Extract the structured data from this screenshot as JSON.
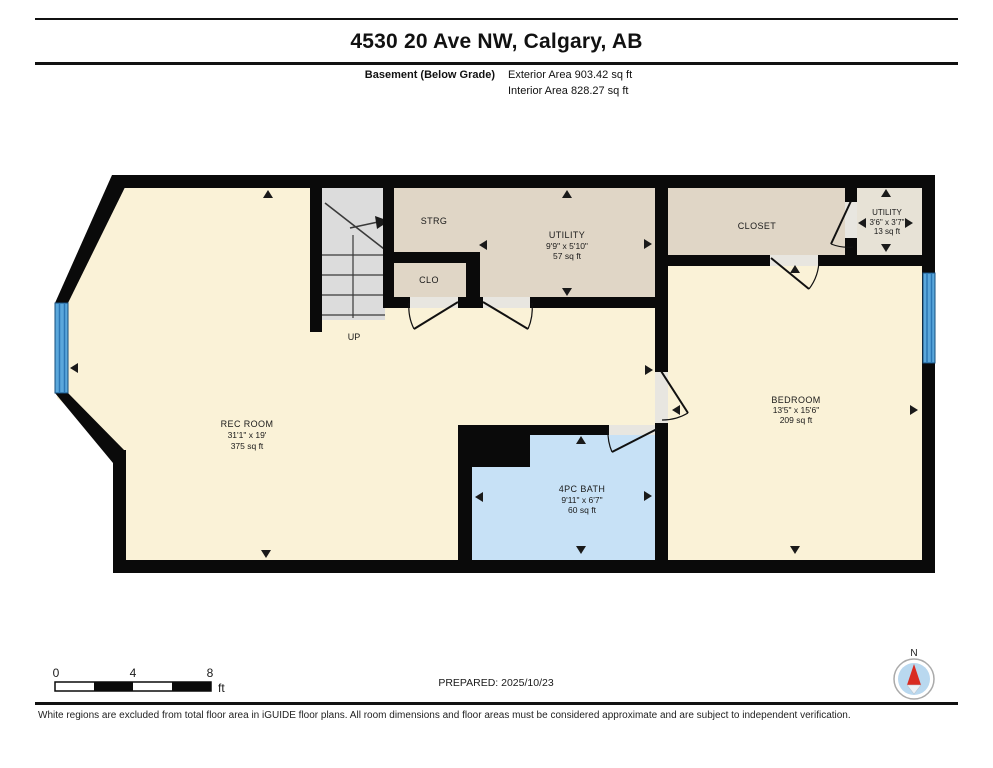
{
  "header": {
    "title": "4530 20 Ave NW, Calgary, AB",
    "floor_label": "Basement (Below Grade)",
    "exterior_area": "Exterior Area 903.42 sq ft",
    "interior_area": "Interior Area 828.27 sq ft"
  },
  "rooms": {
    "rec_room": {
      "name": "REC ROOM",
      "dims": "31'1\" x 19'",
      "area": "375 sq ft"
    },
    "utility": {
      "name": "UTILITY",
      "dims": "9'9\" x 5'10\"",
      "area": "57 sq ft"
    },
    "strg": {
      "name": "STRG"
    },
    "clo": {
      "name": "CLO"
    },
    "closet": {
      "name": "CLOSET"
    },
    "utility_small": {
      "name": "UTILITY",
      "dims": "3'6\" x 3'7\"",
      "area": "13 sq ft"
    },
    "bedroom": {
      "name": "BEDROOM",
      "dims": "13'5\" x 15'6\"",
      "area": "209 sq ft"
    },
    "bath": {
      "name": "4PC BATH",
      "dims": "9'11\" x 6'7\"",
      "area": "60 sq ft"
    }
  },
  "stairs": {
    "label": "UP"
  },
  "scale_bar": {
    "t0": "0",
    "t4": "4",
    "t8": "8",
    "unit": "ft"
  },
  "prepared": {
    "text": "PREPARED: 2025/10/23"
  },
  "compass": {
    "label": "N"
  },
  "footer": {
    "disclaimer": "White regions are excluded from total floor area in iGUIDE floor plans. All room dimensions and floor areas must be considered approximate and are subject to independent verification."
  },
  "colors": {
    "wall": "#0a0a0a",
    "cream": "#FAF2D7",
    "tan": "#E0D6C6",
    "utility_small_floor": "#E7E2D6",
    "bath": "#C7E1F6",
    "stairs": "#DCDCDC",
    "door_frame": "#E8E6E0",
    "window": "#5AA7DB",
    "window_stripe": "#2B77B5",
    "compass_disc": "#B9D8EF",
    "compass_needle": "#D92B21"
  }
}
